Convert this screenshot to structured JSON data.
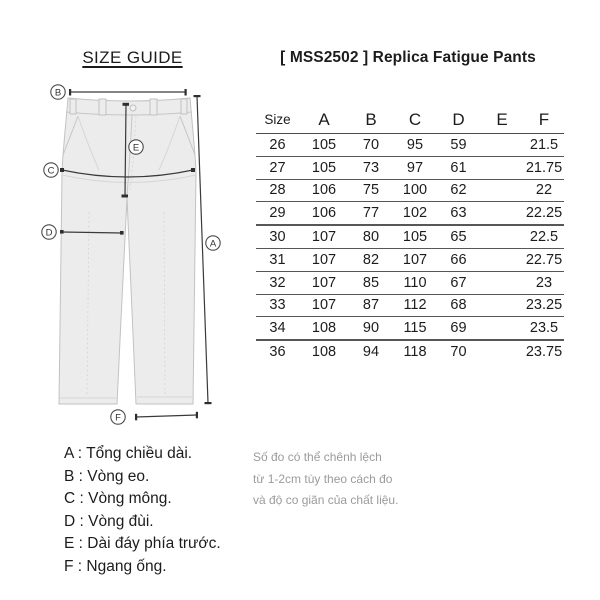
{
  "page": {
    "size_guide_title": "SIZE GUIDE",
    "product_title": "[ MSS2502 ] Replica Fatigue Pants"
  },
  "diagram": {
    "callouts": [
      "B",
      "A",
      "C",
      "D",
      "E",
      "F"
    ]
  },
  "table": {
    "headers": [
      "Size",
      "A",
      "B",
      "C",
      "D",
      "E",
      "F"
    ],
    "rows": [
      [
        "26",
        "105",
        "70",
        "95",
        "59",
        "",
        "21.5"
      ],
      [
        "27",
        "105",
        "73",
        "97",
        "61",
        "",
        "21.75"
      ],
      [
        "28",
        "106",
        "75",
        "100",
        "62",
        "",
        "22"
      ],
      [
        "29",
        "106",
        "77",
        "102",
        "63",
        "",
        "22.25"
      ],
      [
        "30",
        "107",
        "80",
        "105",
        "65",
        "",
        "22.5"
      ],
      [
        "31",
        "107",
        "82",
        "107",
        "66",
        "",
        "22.75"
      ],
      [
        "32",
        "107",
        "85",
        "110",
        "67",
        "",
        "23"
      ],
      [
        "33",
        "107",
        "87",
        "112",
        "68",
        "",
        "23.25"
      ],
      [
        "34",
        "108",
        "90",
        "115",
        "69",
        "",
        "23.5"
      ],
      [
        "36",
        "108",
        "94",
        "118",
        "70",
        "",
        "23.75"
      ]
    ]
  },
  "legend": {
    "items": [
      "A : Tổng chiều dài.",
      "B : Vòng eo.",
      "C : Vòng mông.",
      "D : Vòng đùi.",
      "E : Dài đáy phía trước.",
      "F : Ngang ống."
    ]
  },
  "note": {
    "lines": [
      "Số đo có thể chênh lệch",
      "từ 1-2cm tùy theo cách đo",
      "và độ co giãn của chất liệu."
    ]
  },
  "colors": {
    "text": "#1c1c1c",
    "note_text": "#9b9b9b",
    "table_line": "#575757",
    "measure_line": "#3a3a3a",
    "pants_fill": "#ececec",
    "pants_stroke": "#c2c2c2"
  }
}
